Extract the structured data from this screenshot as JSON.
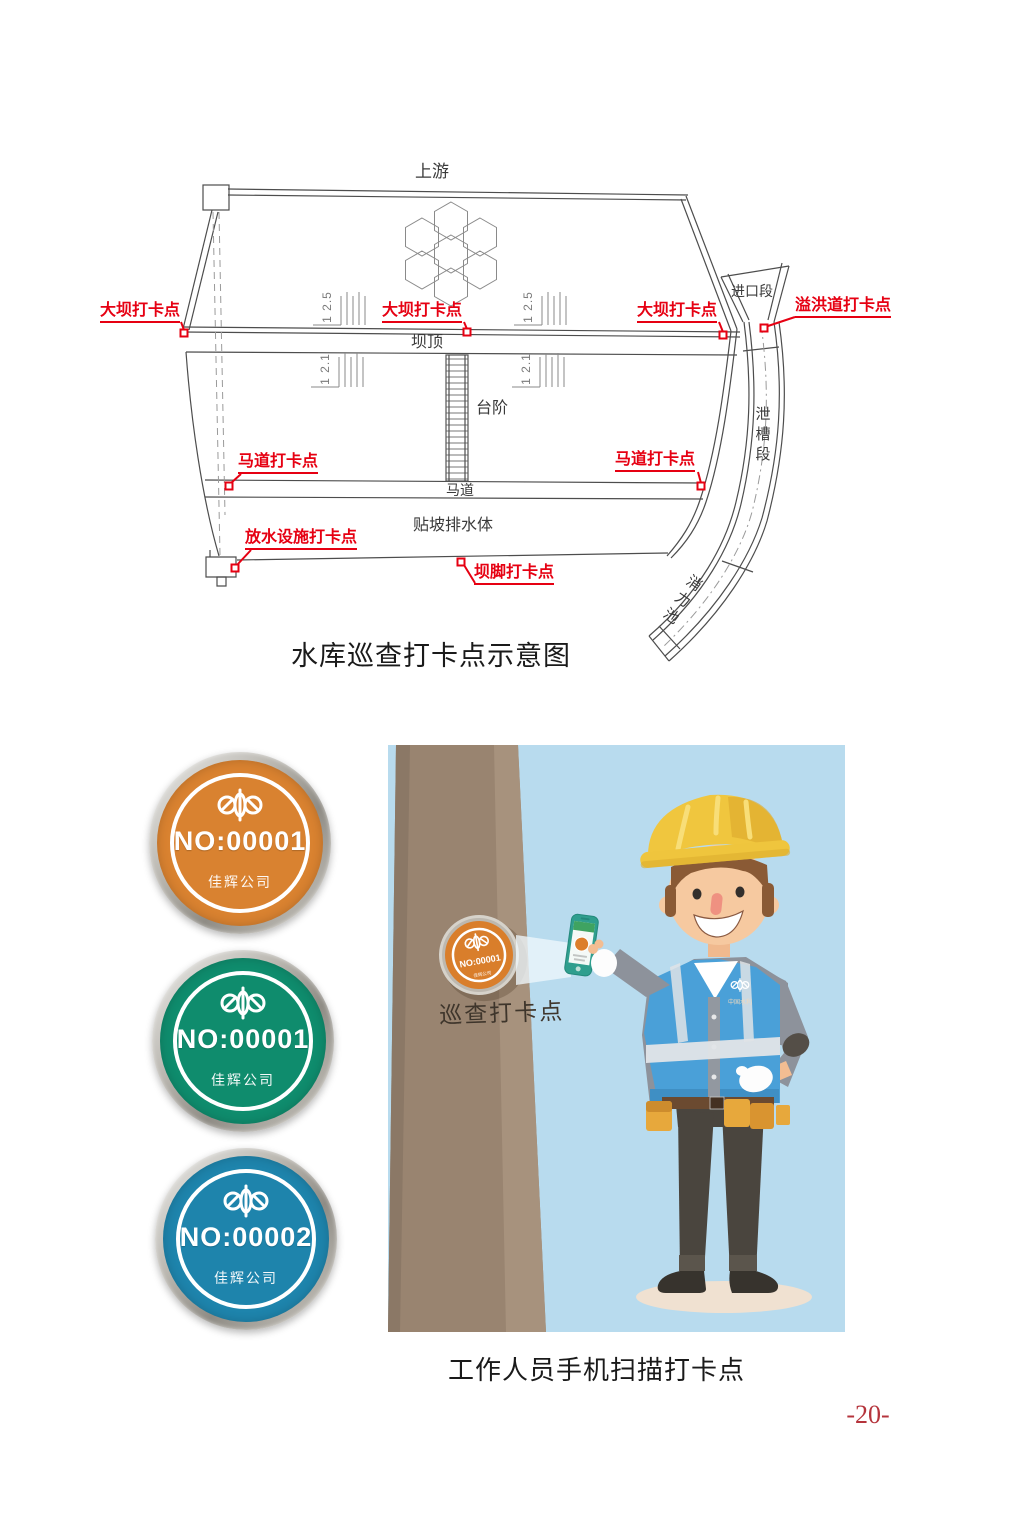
{
  "page": {
    "number_label": "-20-"
  },
  "diagram": {
    "caption": "水库巡查打卡点示意图",
    "labels": {
      "upstream": "上游",
      "dam_crest": "坝顶",
      "steps": "台阶",
      "berm": "马道",
      "slope_drainage": "贴坡排水体",
      "inlet_section": "进口段",
      "chute_section": "泄槽段",
      "stilling_basin": "消力池",
      "slope_ratio_upper": "1  2.5",
      "slope_ratio_lower": "1  2.1"
    },
    "checkpoints": {
      "dam_left": "大坝打卡点",
      "dam_center": "大坝打卡点",
      "dam_right": "大坝打卡点",
      "spillway": "溢洪道打卡点",
      "berm_left": "马道打卡点",
      "berm_right": "马道打卡点",
      "water_release": "放水设施打卡点",
      "dam_toe": "坝脚打卡点"
    },
    "marker_color": "#e60012"
  },
  "badges": {
    "items": [
      {
        "number": "NO:00001",
        "company": "佳辉公司",
        "color": "#d98230"
      },
      {
        "number": "NO:00001",
        "company": "佳辉公司",
        "color": "#0f8c6d"
      },
      {
        "number": "NO:00002",
        "company": "佳辉公司",
        "color": "#1e84ac"
      }
    ]
  },
  "illustration": {
    "caption": "工作人员手机扫描打卡点",
    "wall_label": "巡查打卡点",
    "wall_badge": {
      "number": "NO:00001",
      "company": "佳辉公司"
    },
    "vest_logo_text": "中国水利"
  }
}
